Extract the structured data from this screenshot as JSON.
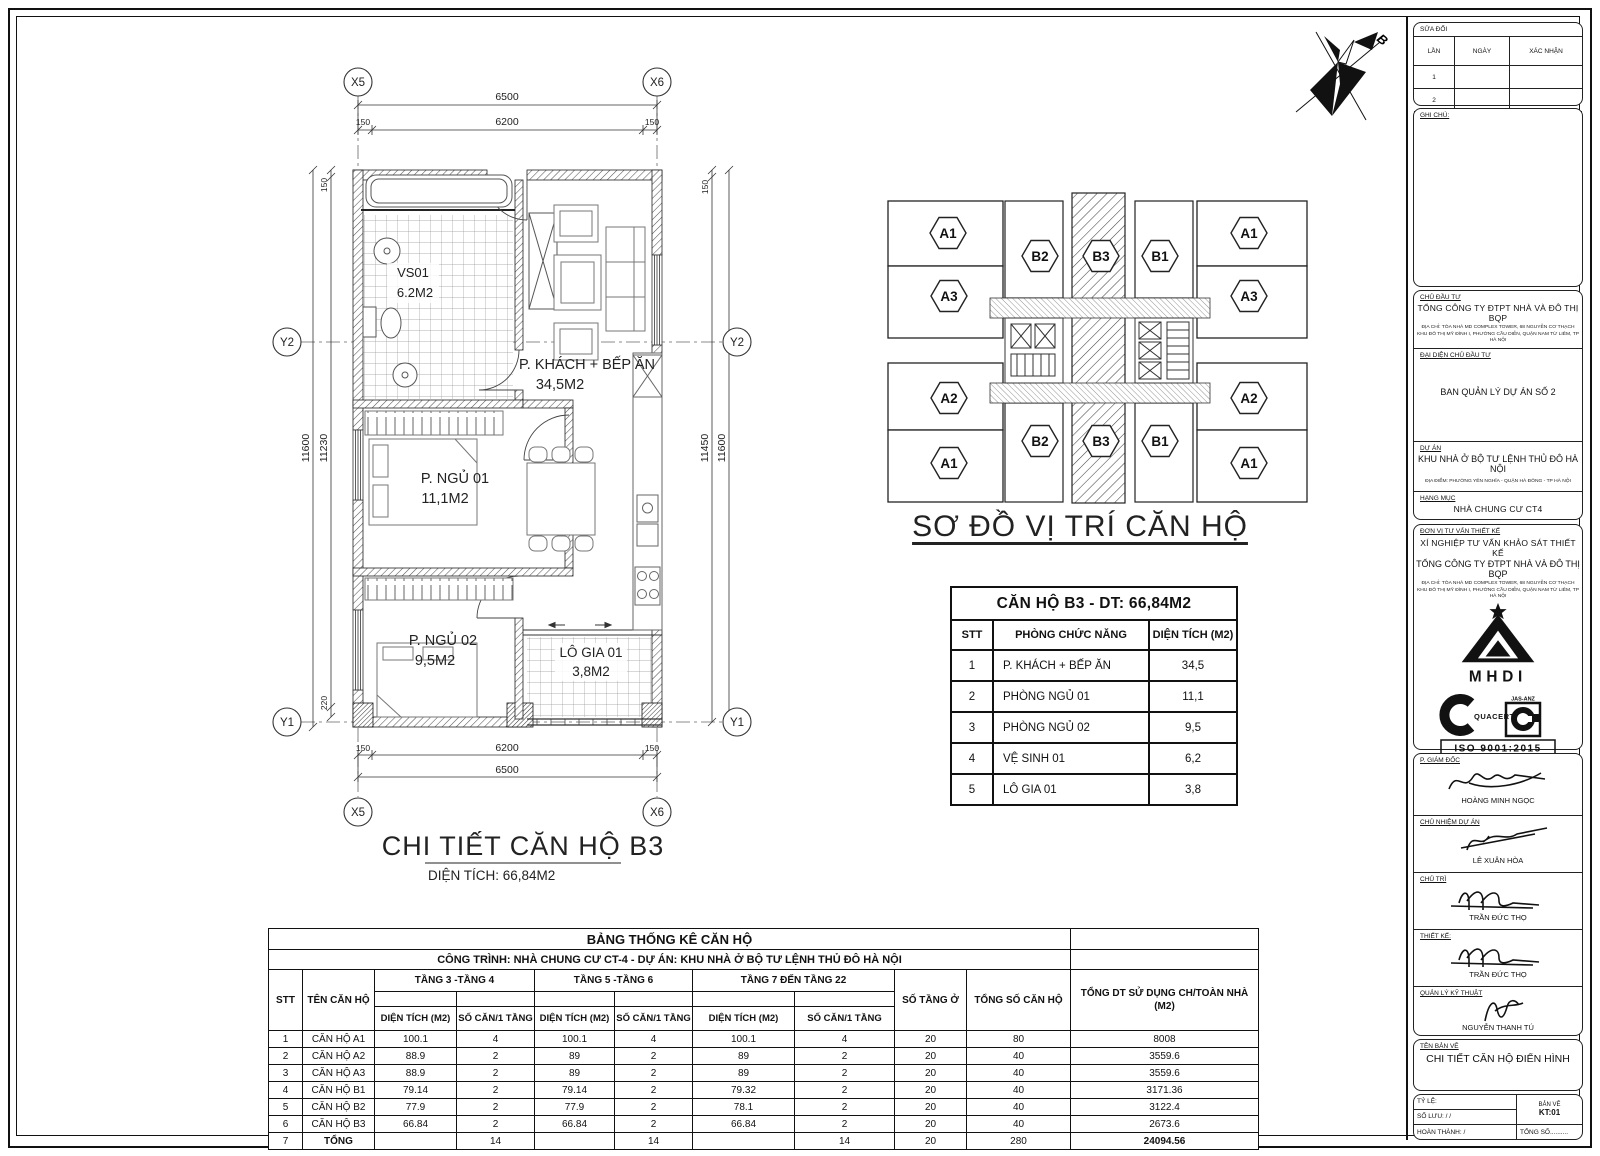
{
  "north": {
    "label": "B"
  },
  "floor_plan": {
    "title": "CHI TIẾT CĂN HỘ B3",
    "subtitle": "DIỆN TÍCH: 66,84M2",
    "grid": {
      "x_left": "X5",
      "x_right": "X6",
      "y_top": "Y2",
      "y_bottom": "Y1"
    },
    "dims": {
      "w_overall": "6500",
      "w_inner": "6200",
      "s150": "150",
      "l_outer": "11600",
      "l_inner": "11230",
      "l_220": "220",
      "r_inner": "11450",
      "r_outer": "11600"
    },
    "rooms": [
      {
        "name": "VS01",
        "area": "6.2M2"
      },
      {
        "name": "P. KHÁCH + BẾP ĂN",
        "area": "34,5M2"
      },
      {
        "name": "P. NGỦ 01",
        "area": "11,1M2"
      },
      {
        "name": "P. NGỦ 02",
        "area": "9,5M2"
      },
      {
        "name": "LÔ GIA 01",
        "area": "3,8M2"
      }
    ]
  },
  "key_plan": {
    "title": "SƠ ĐỒ VỊ TRÍ CĂN HỘ",
    "badges": [
      "A1",
      "B2",
      "B3",
      "B1",
      "A1",
      "A3",
      "A3",
      "A2",
      "A2",
      "A1",
      "B2",
      "B3",
      "B1",
      "A1"
    ]
  },
  "unit_table": {
    "title": "CĂN HỘ B3 - DT: 66,84M2",
    "headers": {
      "stt": "STT",
      "room": "PHÒNG CHỨC NĂNG",
      "area": "DIỆN TÍCH (M2)"
    },
    "rows": [
      [
        "1",
        "P. KHÁCH + BẾP ĂN",
        "34,5"
      ],
      [
        "2",
        "PHÒNG NGỦ 01",
        "11,1"
      ],
      [
        "3",
        "PHÒNG NGỦ 02",
        "9,5"
      ],
      [
        "4",
        "VỆ SINH 01",
        "6,2"
      ],
      [
        "5",
        "LÔ GIA 01",
        "3,8"
      ]
    ]
  },
  "stats_table": {
    "title": "BẢNG THỐNG KÊ CĂN HỘ",
    "subtitle": "CÔNG TRÌNH: NHÀ CHUNG CƯ CT-4 - DỰ ÁN: KHU NHÀ Ở BỘ TƯ LỆNH THỦ ĐÔ HÀ NỘI",
    "groups": [
      "TẦNG 3 -TẦNG 4",
      "TẦNG 5 -TẦNG 6",
      "TẦNG 7 ĐẾN TẦNG 22"
    ],
    "cols": {
      "stt": "STT",
      "name": "TÊN CĂN HỘ",
      "area": "DIỆN TÍCH (M2)",
      "units": "SỐ CĂN/1 TẦNG",
      "floors": "SỐ TẦNG Ở",
      "total_units": "TỔNG SỐ CĂN HỘ",
      "total_area_1": "TỔNG DT SỬ DỤNG CH/TOÀN NHÀ",
      "total_area_2": "(M2)"
    },
    "rows": [
      [
        "1",
        "CĂN HỘ A1",
        "100.1",
        "4",
        "100.1",
        "4",
        "100.1",
        "4",
        "20",
        "80",
        "8008"
      ],
      [
        "2",
        "CĂN HỘ A2",
        "88.9",
        "2",
        "89",
        "2",
        "89",
        "2",
        "20",
        "40",
        "3559.6"
      ],
      [
        "3",
        "CĂN HỘ A3",
        "88.9",
        "2",
        "89",
        "2",
        "89",
        "2",
        "20",
        "40",
        "3559.6"
      ],
      [
        "4",
        "CĂN HỘ B1",
        "79.14",
        "2",
        "79.14",
        "2",
        "79.32",
        "2",
        "20",
        "40",
        "3171.36"
      ],
      [
        "5",
        "CĂN HỘ B2",
        "77.9",
        "2",
        "77.9",
        "2",
        "78.1",
        "2",
        "20",
        "40",
        "3122.4"
      ],
      [
        "6",
        "CĂN HỘ B3",
        "66.84",
        "2",
        "66.84",
        "2",
        "66.84",
        "2",
        "20",
        "40",
        "2673.6"
      ],
      [
        "7",
        "TỔNG",
        "",
        "14",
        "",
        "14",
        "",
        "14",
        "20",
        "280",
        "24094.56"
      ]
    ]
  },
  "title_block": {
    "revision": {
      "label": "SỬA ĐỔI",
      "col1": "LẦN",
      "col2": "NGÀY",
      "col3": "XÁC NHẬN",
      "row1": "1",
      "row2": "2"
    },
    "notes_label": "GHI CHÚ:",
    "investor": {
      "label": "CHỦ ĐẦU TƯ",
      "name": "TỔNG CÔNG TY ĐTPT NHÀ VÀ ĐÔ THỊ BQP",
      "address1": "ĐỊA CHỈ: TÒA NHÀ MD COMPLEX TOWER, 68 NGUYỄN CƠ THẠCH",
      "address2": "KHU ĐÔ THỊ MỸ ĐÌNH I, PHƯỜNG CẦU DIỄN, QUẬN NAM TỪ LIÊM, TP HÀ NỘI"
    },
    "representative": {
      "label": "ĐẠI DIỆN CHỦ ĐẦU TƯ",
      "name": "BAN QUẢN LÝ DỰ ÁN SỐ 2"
    },
    "project": {
      "label": "DỰ ÁN",
      "name": "KHU NHÀ Ở BỘ TƯ LỆNH THỦ ĐÔ HÀ NỘI",
      "address": "ĐỊA ĐIỂM: PHƯỜNG YÊN NGHĨA - QUẬN HÀ ĐÔNG - TP HÀ NỘI"
    },
    "item": {
      "label": "HẠNG MỤC",
      "name": "NHÀ CHUNG CƯ CT4"
    },
    "designer": {
      "label": "ĐƠN VỊ TƯ VẤN THIẾT KẾ",
      "line1": "XÍ NGHIỆP TƯ VẤN KHẢO SÁT THIẾT KẾ",
      "line2": "TỔNG CÔNG TY ĐTPT NHÀ VÀ ĐÔ THỊ BQP",
      "address1": "ĐỊA CHỈ: TÒA NHÀ MD COMPLEX TOWER, 68 NGUYỄN CƠ THẠCH",
      "address2": "KHU ĐÔ THỊ MỸ ĐÌNH I, PHƯỜNG CẦU DIỄN, QUẬN NAM TỪ LIÊM, TP HÀ NỘI",
      "logo1": "MHDI",
      "logo2": "QUACERT",
      "logo2_right": "JAS-ANZ",
      "logo2_iso": "ISO 9001:2015"
    },
    "signatures": [
      {
        "label": "P. GIÁM ĐỐC",
        "name": "HOÀNG MINH NGỌC"
      },
      {
        "label": "CHỦ NHIỆM DỰ ÁN",
        "name": "LÊ XUÂN HÒA"
      },
      {
        "label": "CHỦ TRÌ",
        "name": "TRẦN ĐỨC THỌ"
      },
      {
        "label": "THIẾT KẾ:",
        "name": "TRẦN ĐỨC THỌ"
      },
      {
        "label": "QUẢN LÝ KỸ THUẬT",
        "name": "NGUYỄN THANH TÚ"
      }
    ],
    "drawing": {
      "label": "TÊN BẢN VẼ",
      "name": "CHI TIẾT CĂN HỘ ĐIỂN HÌNH"
    },
    "info": {
      "scale_label": "TỶ LỆ:",
      "file_label": "SỐ LƯU:       /       /",
      "complete_label": "HOÀN THÀNH:       /",
      "sheet_label": "BẢN VẼ",
      "sheet_no": "KT:01",
      "total_label": "TỔNG SỐ.........."
    }
  }
}
